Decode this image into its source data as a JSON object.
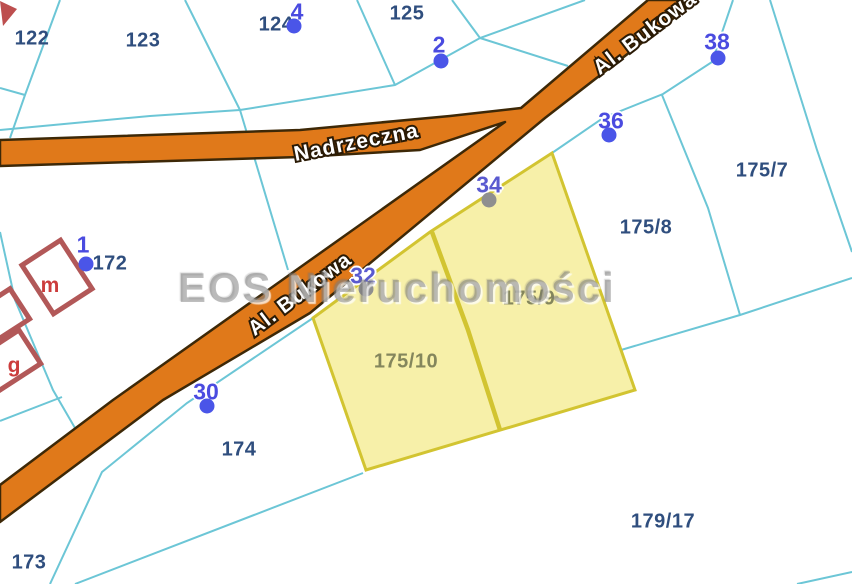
{
  "watermark": {
    "text": "EOS Nieruchomości"
  },
  "roads": {
    "nadrzeczna_label": "Nadrzeczna",
    "bukowa_label_top": "Al. Bukowa",
    "bukowa_label_mid": "Al. Bukowa"
  },
  "parcels": [
    {
      "id": "122",
      "label": "122",
      "color": "#2f4e7e"
    },
    {
      "id": "123",
      "label": "123",
      "color": "#2f4e7e"
    },
    {
      "id": "124",
      "label": "124",
      "color": "#2f4e7e"
    },
    {
      "id": "125",
      "label": "125",
      "color": "#2f4e7e"
    },
    {
      "id": "172",
      "label": "172",
      "color": "#2f4e7e"
    },
    {
      "id": "173",
      "label": "173",
      "color": "#2f4e7e"
    },
    {
      "id": "174",
      "label": "174",
      "color": "#2f4e7e"
    },
    {
      "id": "175/7",
      "label": "175/7",
      "color": "#2f4e7e"
    },
    {
      "id": "175/8",
      "label": "175/8",
      "color": "#2f4e7e"
    },
    {
      "id": "179/17",
      "label": "179/17",
      "color": "#2f4e7e"
    },
    {
      "id": "175/10",
      "label": "175/10",
      "color": "#84865c"
    },
    {
      "id": "175/9",
      "label": "175/9",
      "color": "#84865c"
    }
  ],
  "highlighted_parcels": [
    "175/10",
    "175/9"
  ],
  "address_markers": [
    {
      "number": "1",
      "color": "#4a4be0",
      "dot_color": "#4a55e8"
    },
    {
      "number": "4",
      "color": "#4a4be0",
      "dot_color": "#4a55e8"
    },
    {
      "number": "2",
      "color": "#4a4be0",
      "dot_color": "#4a55e8"
    },
    {
      "number": "38",
      "color": "#4a4be0",
      "dot_color": "#4a55e8"
    },
    {
      "number": "36",
      "color": "#4a4be0",
      "dot_color": "#4a55e8"
    },
    {
      "number": "34",
      "color": "#5a5ad0",
      "dot_color": "#8f8f8f"
    },
    {
      "number": "32",
      "color": "#5a5ad0",
      "dot_color": "#8f8f8f"
    },
    {
      "number": "30",
      "color": "#4a4be0",
      "dot_color": "#4a55e8"
    }
  ],
  "buildings": [
    {
      "letter": "m"
    },
    {
      "letter": "g"
    }
  ],
  "colors": {
    "boundary": "#6cc6d6",
    "road_fill": "#e0791a",
    "road_border": "#3d2807",
    "highlight_fill": "#f6efa2",
    "highlight_border": "#d2c431",
    "building_red": "#b25858",
    "building_letter": "#cc3c3c"
  }
}
